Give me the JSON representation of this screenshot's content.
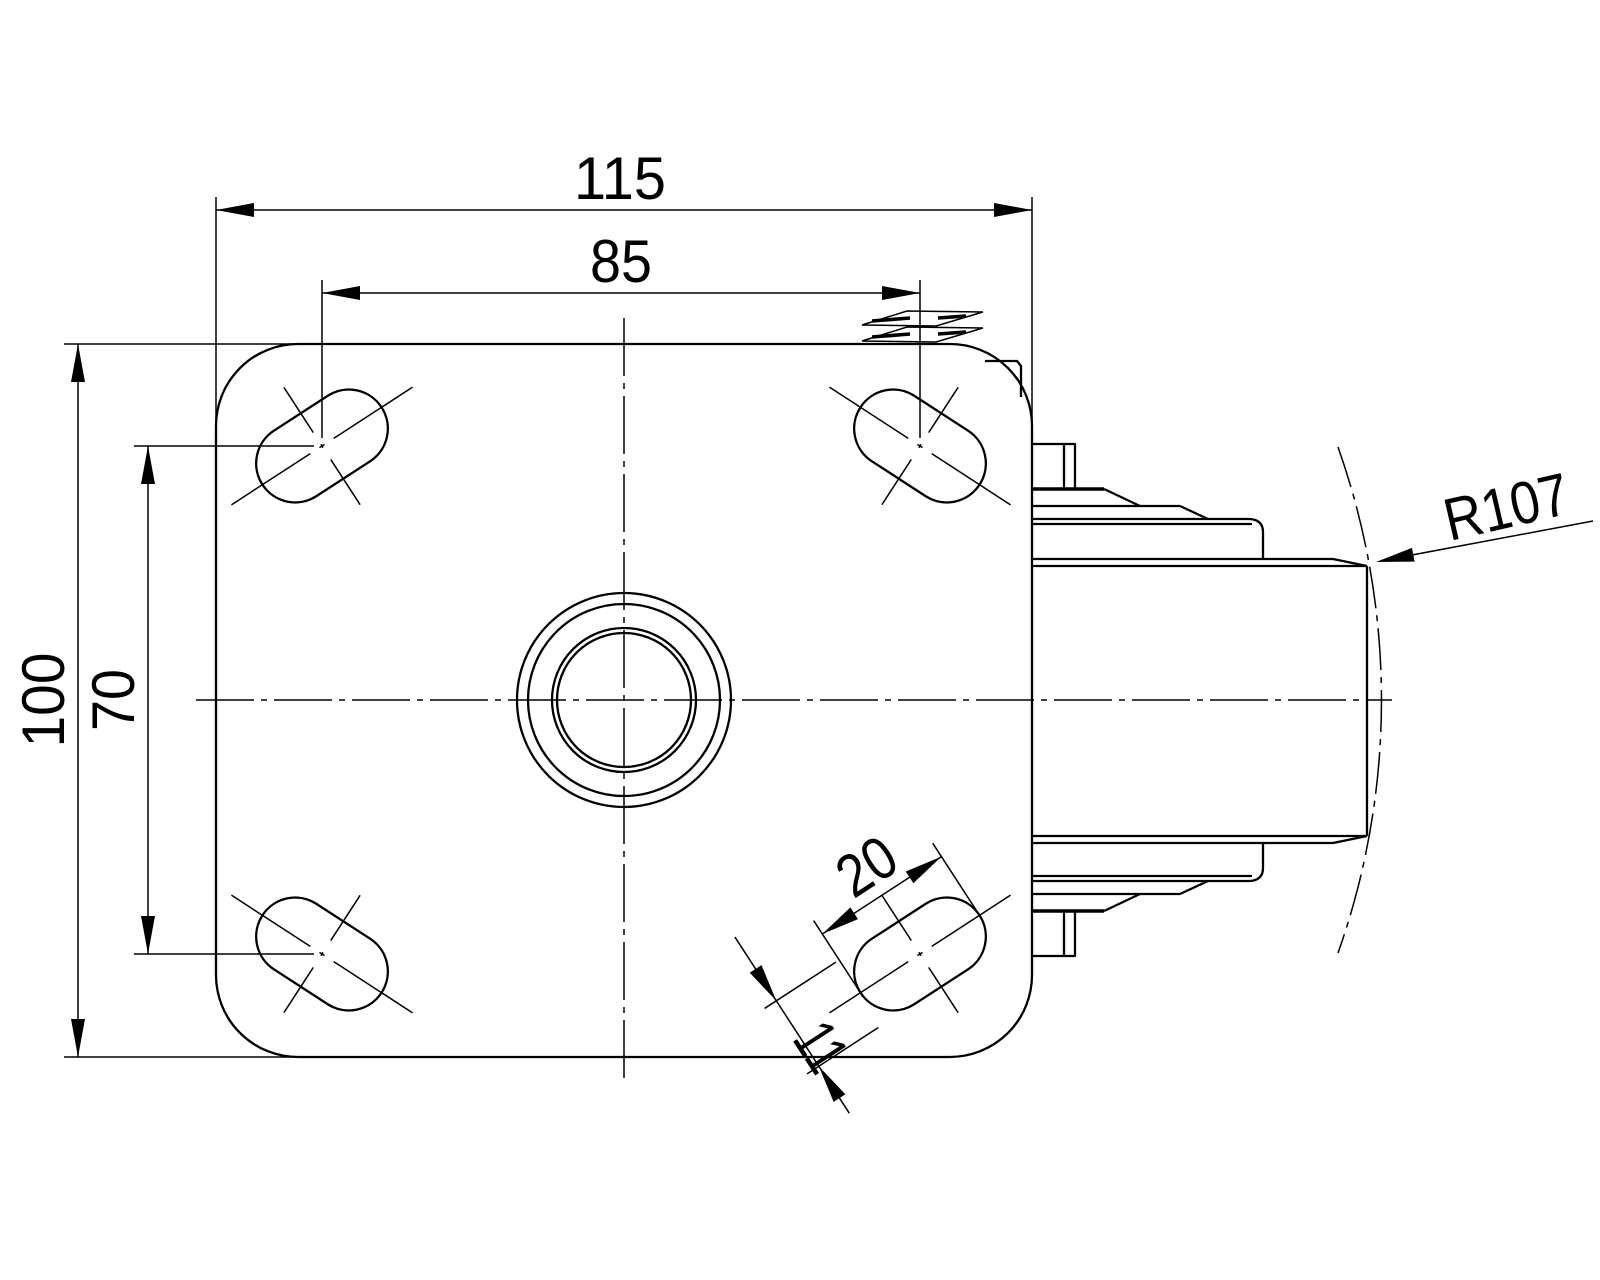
{
  "drawing": {
    "kind": "technical-drawing",
    "subject": "swivel-caster-top-view-with-wheel-side-profile",
    "colors": {
      "line": "#000000",
      "background": "#ffffff"
    },
    "dimensions": {
      "plate_width": "115",
      "hole_spacing_horizontal": "85",
      "plate_height": "100",
      "hole_spacing_vertical": "70",
      "slot_length": "20",
      "slot_width": "11",
      "swivel_radius": "R107"
    }
  }
}
